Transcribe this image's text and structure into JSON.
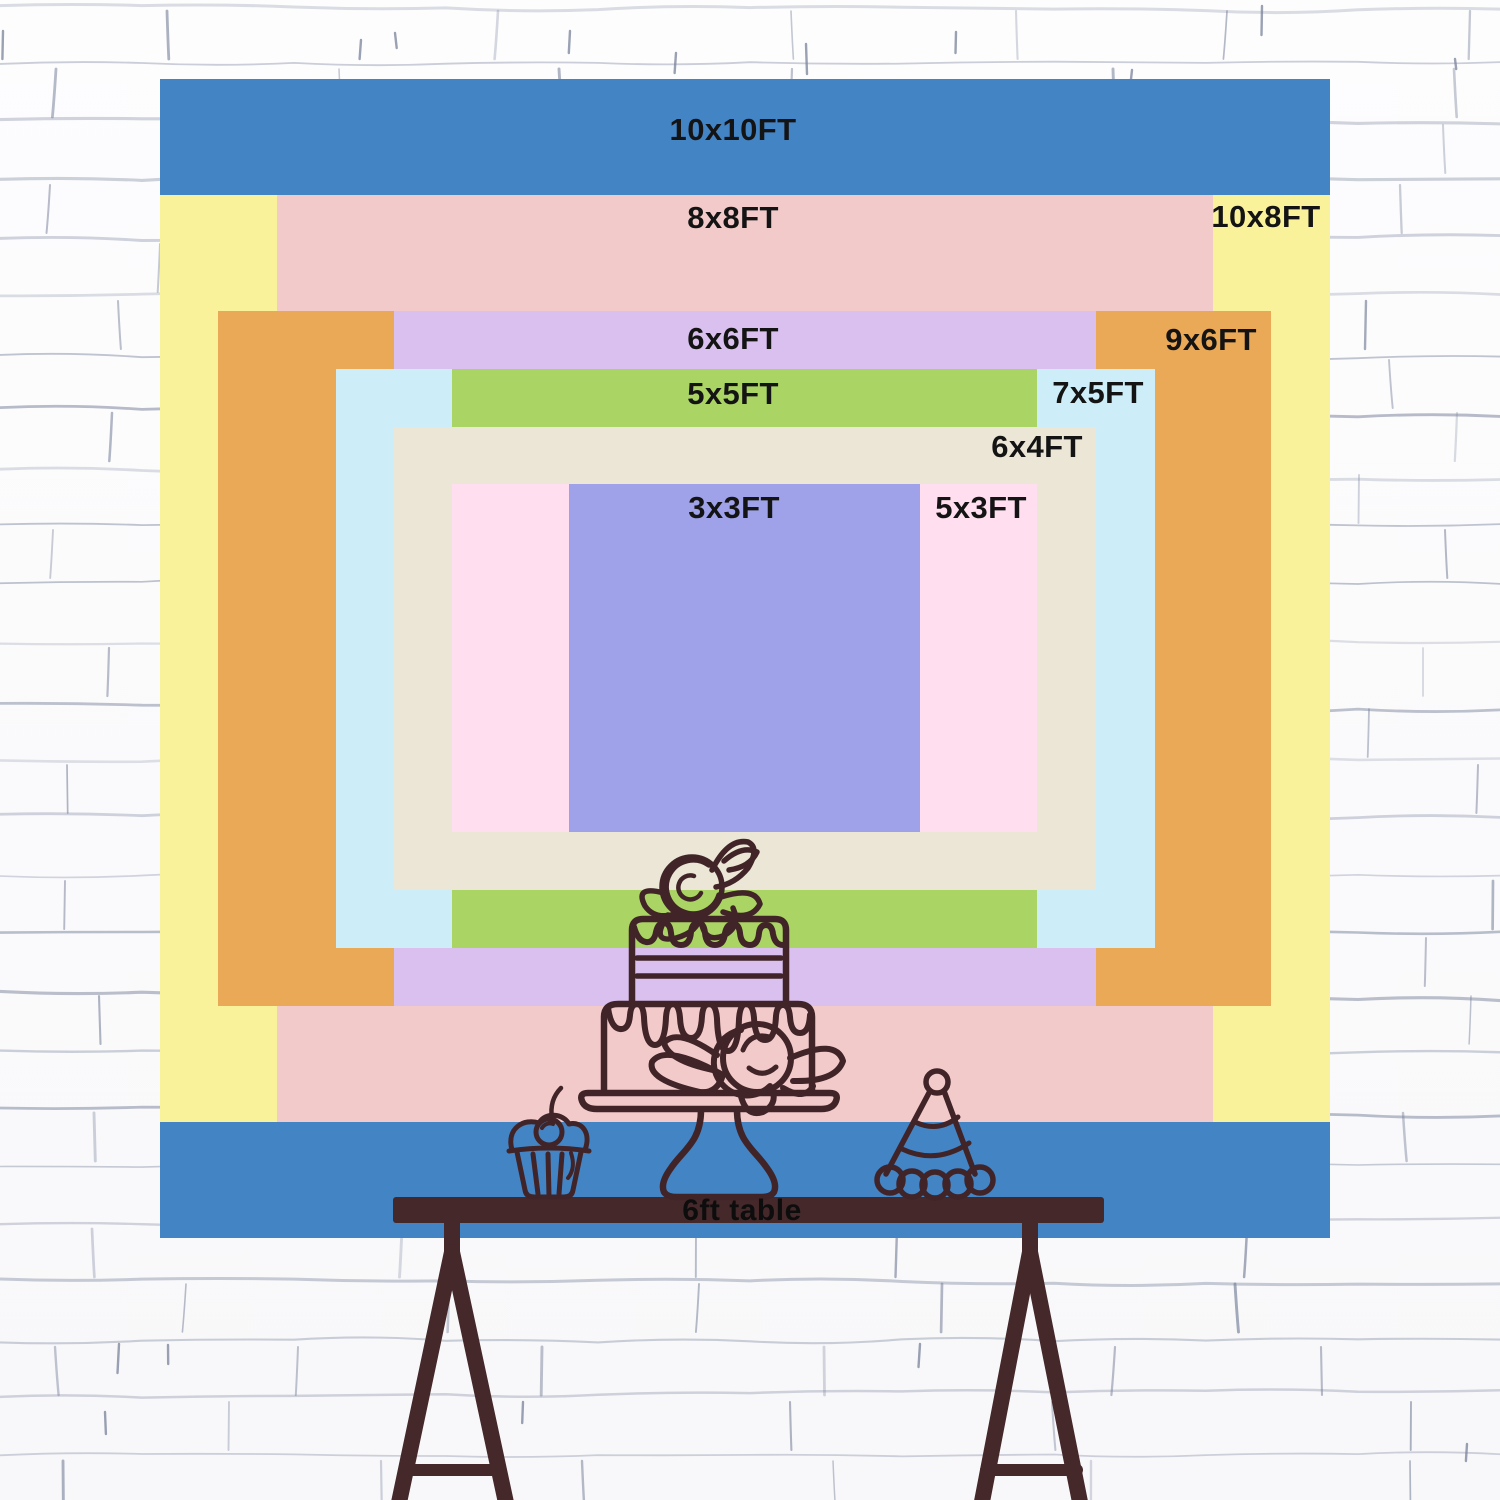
{
  "title": "backdrop-size-chart",
  "sizes": [
    {
      "label": "10x10FT",
      "color": "#4384c5"
    },
    {
      "label": "10x8FT",
      "color": "#faf29a"
    },
    {
      "label": "8x8FT",
      "color": "#f3caca"
    },
    {
      "label": "9x6FT",
      "color": "#eaa956"
    },
    {
      "label": "6x6FT",
      "color": "#d9c0ee"
    },
    {
      "label": "7x5FT",
      "color": "#cdeef8"
    },
    {
      "label": "5x5FT",
      "color": "#aad463"
    },
    {
      "label": "6x4FT",
      "color": "#ebe6d5"
    },
    {
      "label": "5x3FT",
      "color": "#ffdfef"
    },
    {
      "label": "3x3FT",
      "color": "#9fa2e8"
    }
  ],
  "table": {
    "label": "6ft table",
    "wood_color": "#45282a"
  },
  "artwork": {
    "line_color": "#402428",
    "items": [
      "cupcake",
      "layer-cake-on-stand",
      "party-hat"
    ]
  },
  "text": {
    "label_color": "#141414"
  },
  "background": {
    "style": "white-brick-wall",
    "mortar_color": "#78819a"
  }
}
